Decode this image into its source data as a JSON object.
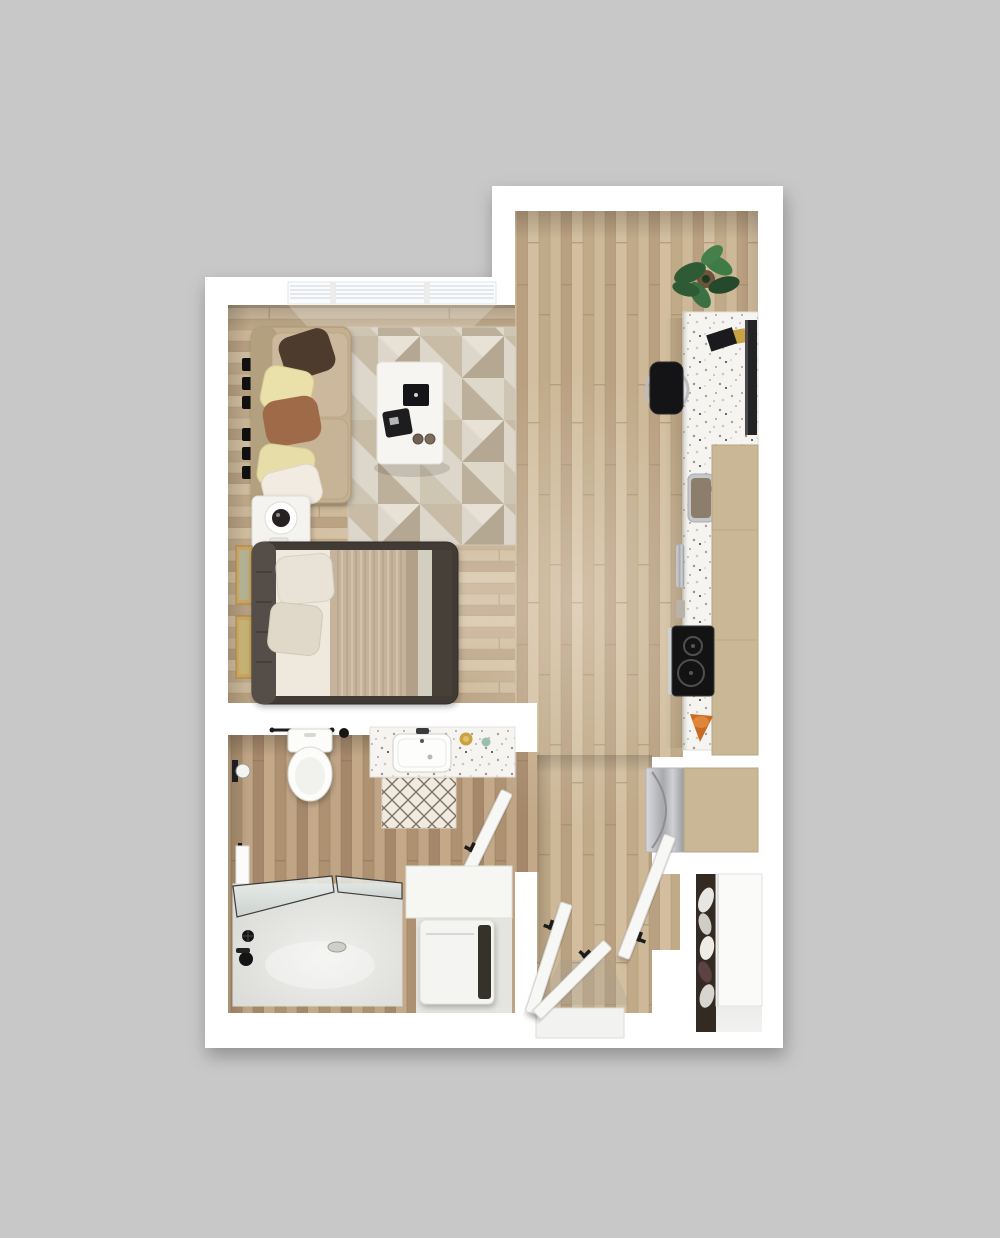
{
  "meta": {
    "type": "3d-floor-plan",
    "view": "top-down",
    "layout": "studio-apartment"
  },
  "colors": {
    "bg": "#c8c8c8",
    "wall": "#ffffff",
    "counter": "#f5f4f1",
    "cabinet": "#c9b795",
    "rug": "#dcd5c8",
    "sofa": "#c4b08f",
    "bedFrame": "#403b36",
    "mattress": "#eee8dd",
    "blanket": "#c6b39b",
    "blanketDark": "#473f37",
    "pillowCream": "#e9e0aa",
    "pillowBrown": "#4e3b2d",
    "pillowRust": "#9e6a46",
    "pillowWhite": "#f1ebe2",
    "table": "#f7f5f1",
    "applianceBlack": "#141416",
    "chrome": "#b9bcc0",
    "tv": "#232326",
    "plant": "#35663c",
    "pot": "#6f523c",
    "orange": "#d2702a",
    "gold": "#c9a243",
    "door": "#f7f7f5",
    "fixture": "#fcfcfb",
    "tub": "#e5e6e2",
    "washer": "#f4f4f2",
    "shoes": "#332b21",
    "teal": "#8fb8ac",
    "matLattice": "#6a594b",
    "woodLight": "#cbb491",
    "woodDark": "#b99d7c"
  },
  "rooms": [
    {
      "id": "living-sleeping-area",
      "items": [
        "window-blinds",
        "wall-shelves",
        "sofa",
        "throw-pillows",
        "area-rug",
        "coffee-table",
        "laptop",
        "serving-tray",
        "cups",
        "nightstand",
        "table-lamp",
        "wall-art",
        "bed",
        "bed-pillows",
        "duvet"
      ]
    },
    {
      "id": "kitchen",
      "items": [
        "potted-plant",
        "breakfast-bar",
        "bar-stool",
        "wall-tv",
        "books",
        "kitchen-sink",
        "upper-cabinets",
        "cutting-board",
        "induction-cooktop",
        "fruit-bowl",
        "refrigerator"
      ]
    },
    {
      "id": "bathroom",
      "items": [
        "toilet",
        "towel-bar",
        "vanity-sink",
        "soap-dish",
        "bath-mat",
        "bathroom-door",
        "toilet-paper-holder",
        "hand-towel",
        "bathtub",
        "glass-shower-screen",
        "tub-faucet",
        "laundry-counter",
        "washer-dryer"
      ]
    },
    {
      "id": "entry-hall",
      "items": [
        "entry-door",
        "closet-doors",
        "threshold"
      ]
    },
    {
      "id": "entry-closet",
      "items": [
        "shoe-rack",
        "sliding-door"
      ]
    }
  ]
}
